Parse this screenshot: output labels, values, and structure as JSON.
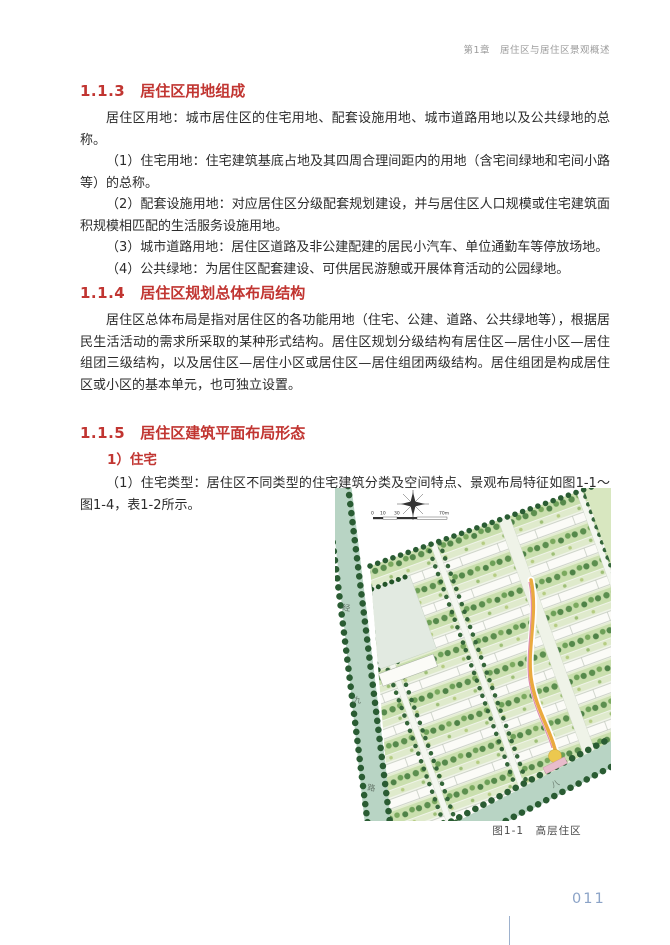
{
  "page": {
    "header": "第1章　居住区与居住区景观概述",
    "page_number": "011"
  },
  "sections": [
    {
      "number": "1.1.3",
      "title": "居住区用地组成",
      "paragraphs": [
        "居住区用地：城市居住区的住宅用地、配套设施用地、城市道路用地以及公共绿地的总称。",
        "（1）住宅用地：住宅建筑基底占地及其四周合理间距内的用地（含宅间绿地和宅间小路等）的总称。",
        "（2）配套设施用地：对应居住区分级配套规划建设，并与居住区人口规模或住宅建筑面积规模相匹配的生活服务设施用地。",
        "（3）城市道路用地：居住区道路及非公建配建的居民小汽车、单位通勤车等停放场地。",
        "（4）公共绿地：为居住区配套建设、可供居民游憩或开展体育活动的公园绿地。"
      ]
    },
    {
      "number": "1.1.4",
      "title": "居住区规划总体布局结构",
      "paragraphs": [
        "居住区总体布局是指对居住区的各功能用地（住宅、公建、道路、公共绿地等），根据居民生活活动的需求所采取的某种形式结构。居住区规划分级结构有居住区—居住小区—居住组团三级结构，以及居住区—居住小区或居住区—居住组团两级结构。居住组团是构成居住区或小区的基本单元，也可独立设置。"
      ]
    },
    {
      "number": "1.1.5",
      "title": "居住区建筑平面布局形态",
      "subheading": "1）住宅",
      "paragraphs": [
        "（1）住宅类型：居住区不同类型的住宅建筑分类及空间特点、景观布局特征如图1-1～图1-4，表1-2所示。"
      ]
    }
  ],
  "figure": {
    "caption": "图1-1　高层住区",
    "scale_ticks": [
      "0",
      "10",
      "30",
      "70m"
    ],
    "road_left_name": "经九路",
    "road_bottom_label": "八"
  },
  "colors": {
    "heading_red": "#c13531",
    "header_gray": "#9a9a9a",
    "body_text": "#2b2b2b",
    "caption_gray": "#4a4a4a",
    "page_number_blue": "#8ba3c7",
    "road_green": "#b8d4c4",
    "tree_dark_green": "#2a5c33",
    "lawn_green": "#cadfae",
    "path_orange": "#eaaa3f"
  }
}
